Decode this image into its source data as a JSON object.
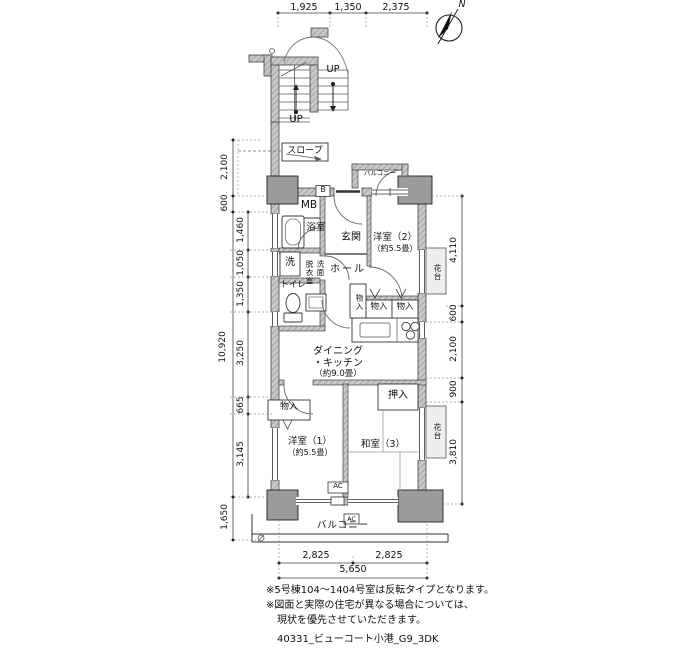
{
  "compass": {
    "north": "N"
  },
  "stairs": {
    "up_upper": "UP",
    "up_lower": "UP",
    "slope": "スロープ"
  },
  "rooms": {
    "mb": "MB",
    "b_box": "B",
    "bath": "浴室",
    "entrance": "玄関",
    "west2": "洋室（2）",
    "west2_size": "（約5.5畳）",
    "washer": "洗",
    "dress_col_right": "洗面",
    "dress_col_left": "脱衣室",
    "hall": "ホール",
    "toilet": "トイレ",
    "storage": "物入",
    "dk_line1": "ダイニング",
    "dk_line2": "・キッチン",
    "dk_line3": "（約9.0畳）",
    "oshiire": "押入",
    "west1": "洋室（1）",
    "west1_size": "（約5.5畳）",
    "japanese3": "和室（3）",
    "hanadai": "花台",
    "ac": "AC",
    "balcony": "バルコニー"
  },
  "dims": {
    "top": [
      "1,925",
      "1,350",
      "2,375"
    ],
    "left_outer": [
      "2,100",
      "600",
      "10,920",
      "1,650"
    ],
    "left_inner": [
      "1,460",
      "1,050",
      "1,350",
      "3,250",
      "665",
      "3,145"
    ],
    "right": [
      "4,110",
      "600",
      "2,100",
      "900",
      "3,810"
    ],
    "bottom": [
      "2,825",
      "2,825"
    ],
    "bottom_total": "5,650"
  },
  "notes": {
    "line1": "※5号棟104〜1404号室は反転タイプとなります。",
    "line2": "※図面と実際の住宅が異なる場合については、",
    "line3": "現状を優先させていただきます。",
    "footer": "40331_ビューコート小港_G9_3DK"
  },
  "colors": {
    "wall_fill": "#c9c9c9",
    "pillar_fill": "#9b9b9b",
    "line": "#222222"
  }
}
